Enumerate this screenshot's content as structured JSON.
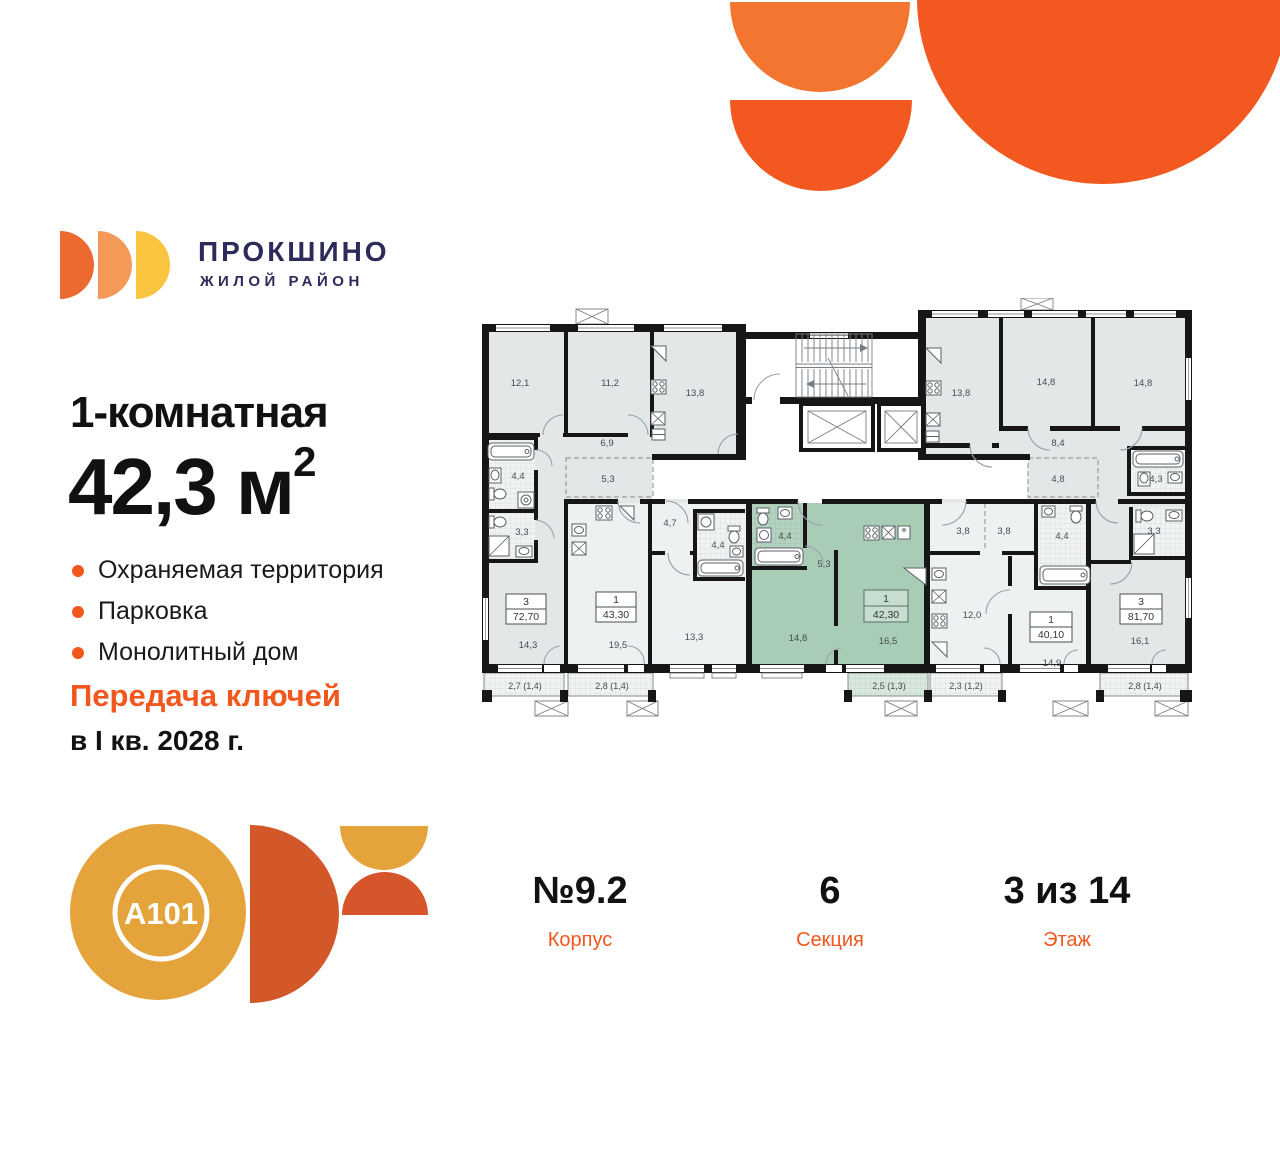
{
  "brand": {
    "name": "ПРОКШИНО",
    "tagline": "ЖИЛОЙ РАЙОН",
    "a101": "A101"
  },
  "offer": {
    "rooms_title": "1-комнатная",
    "area_value": "42,3",
    "area_unit": " м",
    "area_sup": "2",
    "features": [
      "Охраняемая территория",
      "Парковка",
      "Монолитный дом"
    ],
    "handover_line1": "Передача ключей",
    "handover_line2": "в I кв. 2028 г."
  },
  "footer": {
    "korpus": {
      "value": "№9.2",
      "label": "Корпус"
    },
    "sektsiya": {
      "value": "6",
      "label": "Секция"
    },
    "etazh": {
      "value": "3 из 14",
      "label": "Этаж"
    }
  },
  "colors": {
    "accent": "#f2571e",
    "navy": "#2d2b5a",
    "highlight_green": "#a9ccb7"
  },
  "plan": {
    "areas": {
      "r12_1": "12,1",
      "r11_2": "11,2",
      "r13_8l": "13,8",
      "r6_9": "6,9",
      "r5_3": "5,3",
      "r4_4l": "4,4",
      "r3_3l": "3,3",
      "r14_3": "14,3",
      "r19_5": "19,5",
      "r4_7": "4,7",
      "r4_4m": "4,4",
      "r13_3": "13,3",
      "g4_4": "4,4",
      "g5_3": "5,3",
      "g14_8": "14,8",
      "g16_5": "16,5",
      "r13_8r": "13,8",
      "r14_8a": "14,8",
      "r14_8b": "14,8",
      "r8_4": "8,4",
      "r4_8": "4,8",
      "r4_3": "4,3",
      "r3_8a": "3,8",
      "r3_8b": "3,8",
      "r4_4r": "4,4",
      "r12_0": "12,0",
      "r14_9": "14,9",
      "r3_3r": "3,3",
      "r16_1": "16,1"
    },
    "balconies": {
      "b1": "2,7 (1,4)",
      "b2": "2,8 (1,4)",
      "b3": "2,5 (1,3)",
      "b4": "2,3 (1,2)",
      "b5": "2,8 (1,4)"
    },
    "apartments": {
      "a72": {
        "rooms": "3",
        "area": "72,70"
      },
      "a43": {
        "rooms": "1",
        "area": "43,30"
      },
      "a42": {
        "rooms": "1",
        "area": "42,30"
      },
      "a40": {
        "rooms": "1",
        "area": "40,10"
      },
      "a81": {
        "rooms": "3",
        "area": "81,70"
      }
    }
  }
}
